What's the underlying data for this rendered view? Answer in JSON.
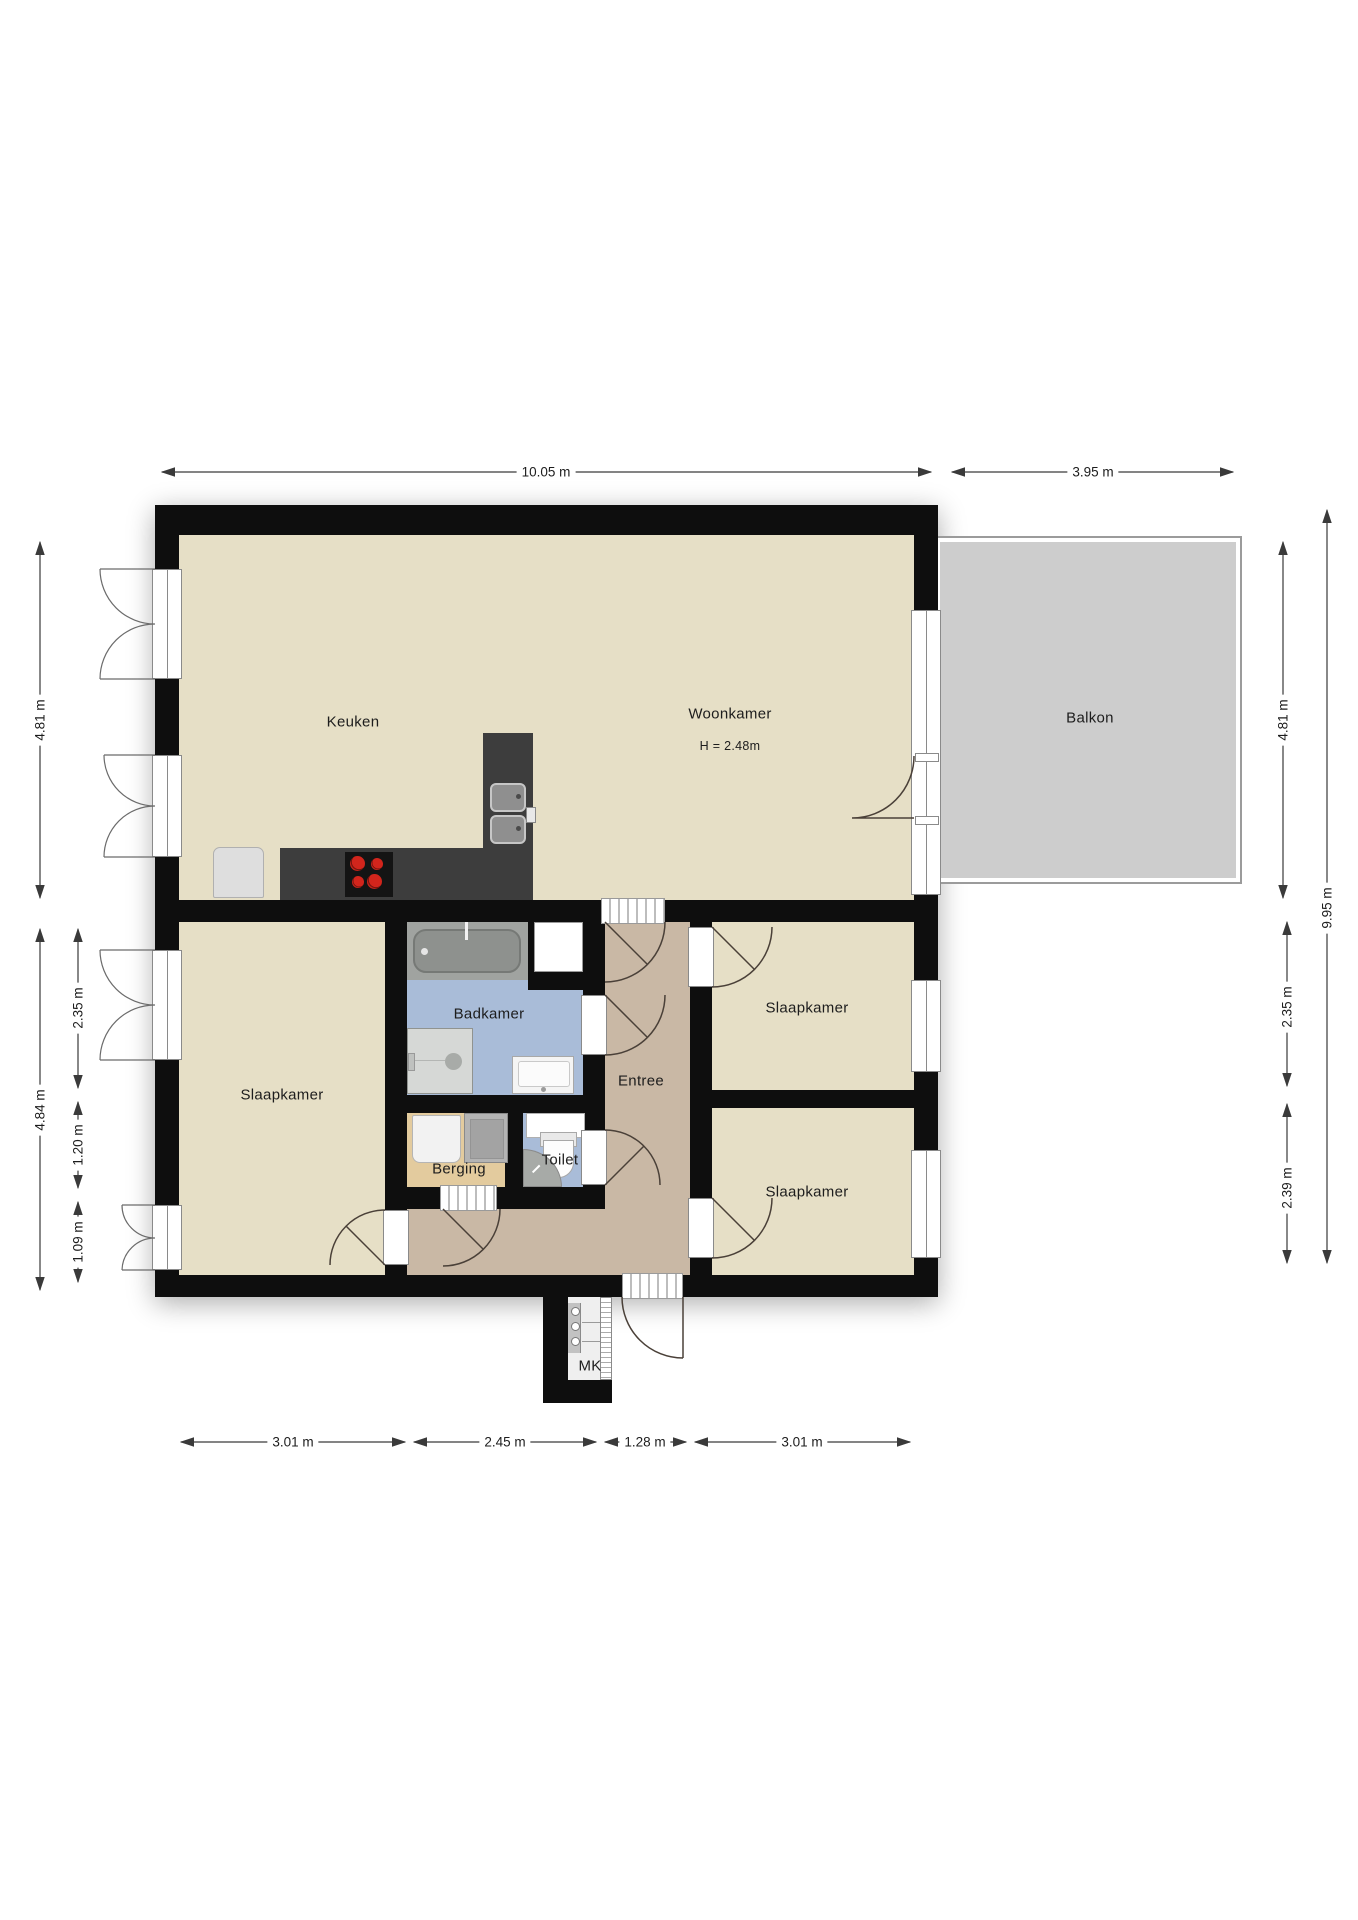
{
  "plan": {
    "canvas": {
      "width": 1358,
      "height": 1920
    },
    "rooms": {
      "keuken": {
        "label": "Keuken"
      },
      "woonkamer": {
        "label": "Woonkamer",
        "ceiling_height": "H = 2.48m"
      },
      "balkon": {
        "label": "Balkon"
      },
      "slaapkamer_links": {
        "label": "Slaapkamer"
      },
      "slaapkamer_rechtsboven": {
        "label": "Slaapkamer"
      },
      "slaapkamer_rechtsonder": {
        "label": "Slaapkamer"
      },
      "badkamer": {
        "label": "Badkamer"
      },
      "entree": {
        "label": "Entree"
      },
      "berging": {
        "label": "Berging"
      },
      "toilet": {
        "label": "Toilet"
      },
      "meterkast": {
        "label": "MK"
      }
    },
    "dimensions": {
      "top_main": "10.05 m",
      "top_balkon": "3.95 m",
      "left_top_block": "4.81 m",
      "left_bottom_block": "4.84 m",
      "left_segment_a": "2.35 m",
      "left_segment_b": "1.20 m",
      "left_segment_c": "1.09 m",
      "right_balkon": "4.81 m",
      "right_total": "9.95 m",
      "right_segment_a": "2.35 m",
      "right_segment_b": "2.39 m",
      "bottom_segment_a": "3.01 m",
      "bottom_segment_b": "2.45 m",
      "bottom_segment_c": "1.28 m",
      "bottom_segment_d": "3.01 m"
    },
    "colors": {
      "wall": "#0e0e0e",
      "floor_main": "#e6dfc6",
      "floor_entree": "#c9b8a5",
      "floor_berging": "#e3cb9e",
      "floor_sanitary": "#a9bcd8",
      "floor_balkon": "#cdcdcd",
      "balkon_rail": "#9b9b9b",
      "counter": "#3d3d3d",
      "burner": "#d2251c",
      "door_arc": "#4a4038",
      "dim_line": "#3a3a3a",
      "text": "#1d1d1d"
    },
    "fixtures": [
      "fridge",
      "kitchen-counter",
      "cooktop",
      "kitchen-sink",
      "bathtub",
      "closet",
      "shower",
      "washbasin",
      "toilet",
      "corner-basin",
      "washer",
      "dryer",
      "meter-panel",
      "front-door",
      "balcony-door"
    ]
  }
}
